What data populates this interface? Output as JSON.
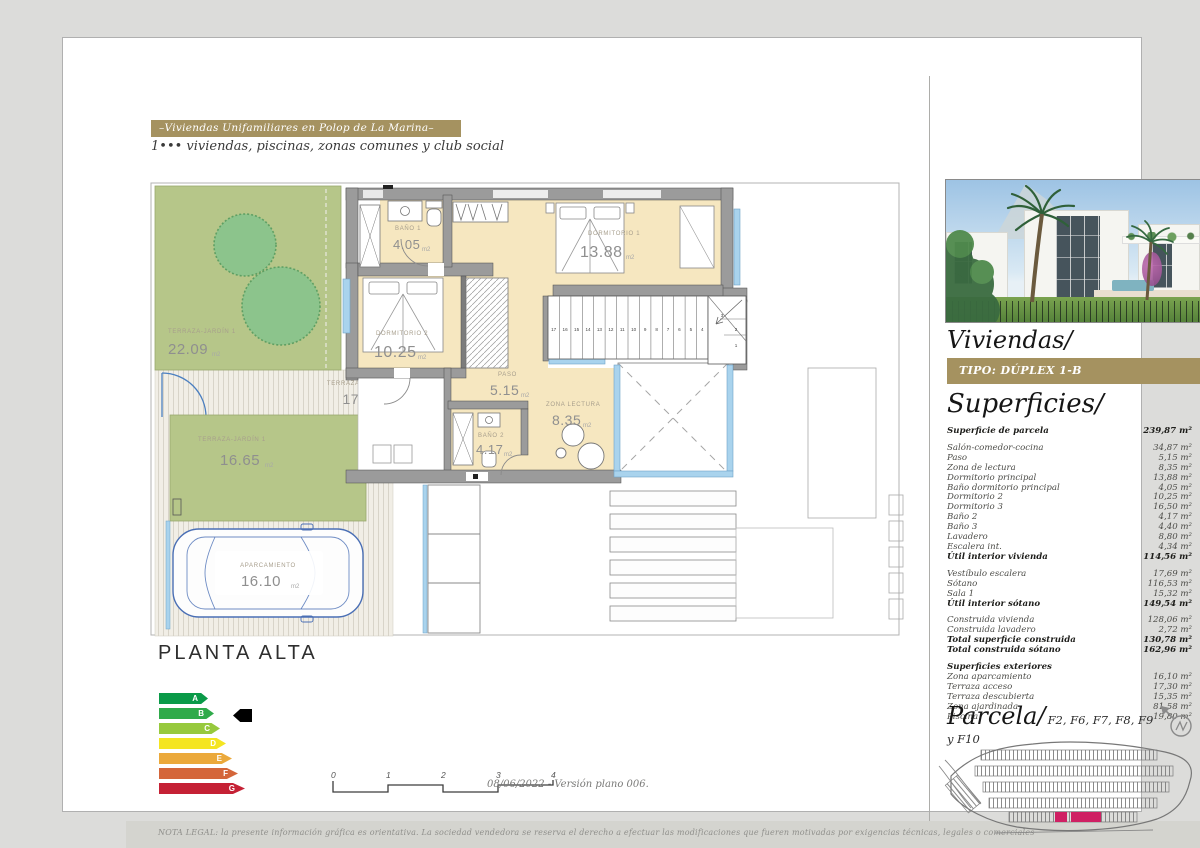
{
  "header": {
    "title": "–Viviendas Unifamiliares en Polop de La Marina–",
    "subtitle": "1••• viviendas, piscinas, zonas comunes y club social"
  },
  "plan": {
    "title": "PLANTA ALTA",
    "rooms": [
      {
        "name": "TERRAZA-JARDÍN 1",
        "area": "22.09",
        "unit": "m2"
      },
      {
        "name": "TERRAZA ACCESO",
        "area": "17.30",
        "unit": "m2"
      },
      {
        "name": "TERRAZA-JARDÍN 1",
        "area": "16.65",
        "unit": "m2"
      },
      {
        "name": "APARCAMIENTO",
        "area": "16.10",
        "unit": "m2"
      },
      {
        "name": "BAÑO 1",
        "area": "4.05",
        "unit": "m2"
      },
      {
        "name": "DORMITORIO 1",
        "area": "13.88",
        "unit": "m2"
      },
      {
        "name": "DORMITORIO 2",
        "area": "10.25",
        "unit": "m2"
      },
      {
        "name": "PASO",
        "area": "5.15",
        "unit": "m2"
      },
      {
        "name": "ZONA LECTURA",
        "area": "8.35",
        "unit": "m2"
      },
      {
        "name": "BAÑO 2",
        "area": "4.17",
        "unit": "m2"
      }
    ],
    "stair_numbers": [
      "17",
      "16",
      "15",
      "14",
      "13",
      "12",
      "11",
      "10",
      "9",
      "8",
      "7",
      "6",
      "5",
      "4"
    ],
    "winder_numbers": [
      "3",
      "2",
      "1"
    ]
  },
  "energy_label": {
    "current_grade": "B",
    "grades": [
      {
        "letter": "A",
        "color": "#0a9a48",
        "cls": "w1"
      },
      {
        "letter": "B",
        "color": "#2faa4a",
        "cls": "w2"
      },
      {
        "letter": "C",
        "color": "#97c93d",
        "cls": "w3"
      },
      {
        "letter": "D",
        "color": "#f4e521",
        "cls": "w4"
      },
      {
        "letter": "E",
        "color": "#ebA93b",
        "cls": "w5"
      },
      {
        "letter": "F",
        "color": "#d4663a",
        "cls": "w6"
      },
      {
        "letter": "G",
        "color": "#c52135",
        "cls": "w7"
      }
    ]
  },
  "scale_bar": {
    "ticks": [
      "0",
      "1",
      "2",
      "3",
      "4"
    ]
  },
  "version_note": "08/06/2022 - Versión plano 006.",
  "legal_note": "NOTA LEGAL: la presente información gráfica es orientativa. La sociedad vendedora se reserva el derecho a efectuar las modificaciones que fueren motivadas por exigencias técnicas, legales o comerciales",
  "sidebar": {
    "viviendas_title": "Viviendas/",
    "tipo_label": "TIPO: DÚPLEX 1-B",
    "superficies_title": "Superficies/",
    "parcela_title": "Parcela/",
    "parcela_refs": "F2, F6, F7, F8, F9 y F10",
    "surface_rows": [
      {
        "label": "Superficie de parcela",
        "value": "239,87 m²",
        "cls": "strong"
      },
      {
        "label": "Salón-comedor-cocina",
        "value": "34,87 m²",
        "cls": "gap"
      },
      {
        "label": "Paso",
        "value": "5,15 m²",
        "cls": ""
      },
      {
        "label": "Zona de lectura",
        "value": "8,35 m²",
        "cls": ""
      },
      {
        "label": "Dormitorio principal",
        "value": "13,88 m²",
        "cls": ""
      },
      {
        "label": "Baño dormitorio principal",
        "value": "4,05 m²",
        "cls": ""
      },
      {
        "label": "Dormitorio 2",
        "value": "10,25 m²",
        "cls": ""
      },
      {
        "label": "Dormitorio 3",
        "value": "16,50 m²",
        "cls": ""
      },
      {
        "label": "Baño 2",
        "value": "4,17 m²",
        "cls": ""
      },
      {
        "label": "Baño 3",
        "value": "4,40 m²",
        "cls": ""
      },
      {
        "label": "Lavadero",
        "value": "8,80 m²",
        "cls": ""
      },
      {
        "label": "Escalera int.",
        "value": "4,34 m²",
        "cls": ""
      },
      {
        "label": "Útil interior vivienda",
        "value": "114,56 m²",
        "cls": "strong"
      },
      {
        "label": "Vestíbulo escalera",
        "value": "17,69 m²",
        "cls": "gap"
      },
      {
        "label": "Sótano",
        "value": "116,53 m²",
        "cls": ""
      },
      {
        "label": "Sala 1",
        "value": "15,32 m²",
        "cls": ""
      },
      {
        "label": "Útil interior sótano",
        "value": "149,54 m²",
        "cls": "strong"
      },
      {
        "label": "Construida vivienda",
        "value": "128,06 m²",
        "cls": "gap"
      },
      {
        "label": "Construida lavadero",
        "value": "2,72 m²",
        "cls": ""
      },
      {
        "label": "Total superficie construida",
        "value": "130,78 m²",
        "cls": "strong"
      },
      {
        "label": "Total construida sótano",
        "value": "162,96 m²",
        "cls": "strong"
      },
      {
        "label": "Superficies exteriores",
        "value": "",
        "cls": "strong gap"
      },
      {
        "label": "Zona aparcamiento",
        "value": "16,10 m²",
        "cls": ""
      },
      {
        "label": "Terraza acceso",
        "value": "17,30 m²",
        "cls": ""
      },
      {
        "label": "Terraza descubierta",
        "value": "15,35 m²",
        "cls": ""
      },
      {
        "label": "Zona ajardinada",
        "value": "81,58 m²",
        "cls": ""
      },
      {
        "label": "Piscina",
        "value": "19,80 m²",
        "cls": ""
      }
    ]
  },
  "colors": {
    "gold": "#a59260",
    "highlight": "#cf2063",
    "cream_room": "#f6e7c0",
    "garden_green": "#b6c689",
    "glass_blue": "#a9d3ed",
    "car_blue": "#4a6fb5",
    "cursor_black": "#000000"
  }
}
